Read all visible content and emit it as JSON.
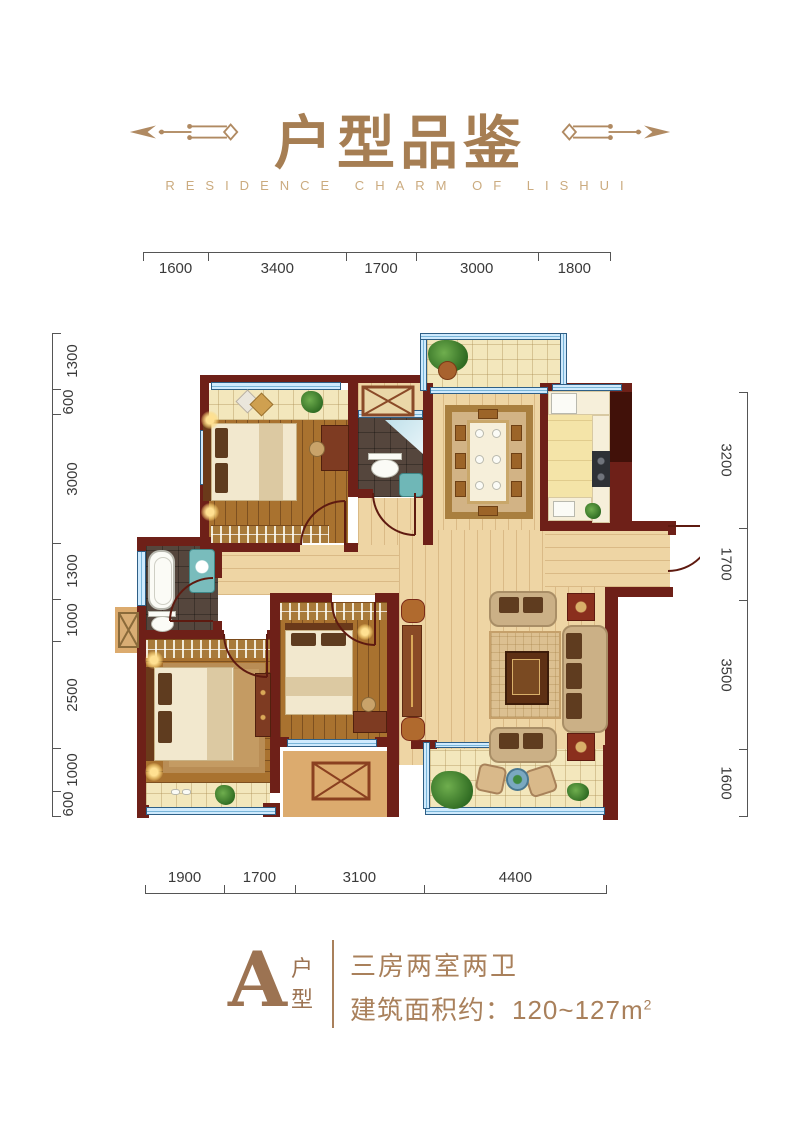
{
  "header": {
    "title": "户型品鉴",
    "subtitle": "RESIDENCE CHARM OF LISHUI"
  },
  "dimensions": {
    "top": [
      "1600",
      "3400",
      "1700",
      "3000",
      "1800"
    ],
    "bottom": [
      "1900",
      "1700",
      "3100",
      "4400"
    ],
    "left": [
      "1300",
      "600",
      "3000",
      "1300",
      "1000",
      "2500",
      "1000",
      "600"
    ],
    "right": [
      "3200",
      "1700",
      "3500",
      "1600"
    ]
  },
  "footer": {
    "unit_letter": "A",
    "unit_type_vertical": [
      "户",
      "型"
    ],
    "rooms_desc": "三房两室两卫",
    "area_label": "建筑面积约：120~127m",
    "area_superscript": "2"
  },
  "colors": {
    "accent_brown": "#a9805b",
    "subtitle_gold": "#cbab7f",
    "wall_maroon": "#6e2018",
    "window_blue": "#cfeafd",
    "wood_light": "#eed5a4",
    "wood_dark": "#a9722f",
    "tile_cream": "#f3e7bc",
    "dim_text": "#3a3a3a"
  }
}
